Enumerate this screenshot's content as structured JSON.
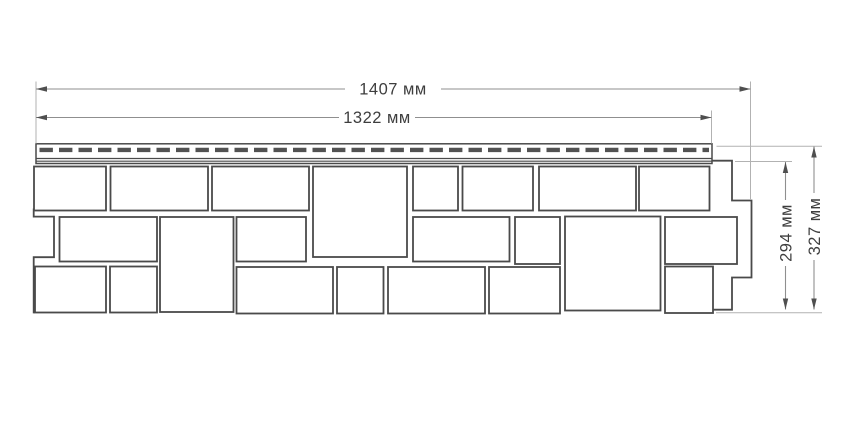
{
  "diagram": {
    "type": "technical-dimension-drawing",
    "subject": "facade-siding-panel-front-view",
    "background": "#ffffff",
    "colors": {
      "stone_outline": "#4a4a4a",
      "stone_fill": "#ffffff",
      "slot_fill": "#525252",
      "dim_line": "#8f8f8f",
      "ext_line": "#b2b2b2",
      "arrow": "#4f4f4f",
      "text": "#3e3e3e"
    },
    "labels": {
      "width_total": "1407 мм",
      "width_hem": "1322 мм",
      "height_panel": "294 мм",
      "height_total": "327 мм"
    },
    "geometry": {
      "canvas": {
        "w": 850,
        "h": 425
      },
      "hem": {
        "x1": 36,
        "y1": 143.8,
        "x2": 712,
        "y2": 163.5,
        "dash_y": 149.9,
        "dash_x1": 39.5,
        "dash_x2": 709,
        "dash_pattern": "13.4 6.1",
        "dash_width": 4.4,
        "inner_lines_y": [
          158.5,
          161.2
        ]
      },
      "stones": [
        [
          34,
          166.5,
          72,
          44
        ],
        [
          110.5,
          166.5,
          97.5,
          44
        ],
        [
          212,
          166.5,
          97,
          44
        ],
        [
          313,
          166.5,
          94,
          90.5
        ],
        [
          413,
          166.5,
          45,
          44
        ],
        [
          462.5,
          166.5,
          70.5,
          44
        ],
        [
          539,
          166.5,
          97,
          44
        ],
        [
          639,
          166.5,
          70.5,
          44
        ],
        [
          59.5,
          217,
          97.5,
          44.5
        ],
        [
          160,
          217,
          73.5,
          95
        ],
        [
          236.5,
          217,
          69.5,
          44.5
        ],
        [
          413,
          217,
          96.5,
          44.5
        ],
        [
          515,
          217,
          45,
          47
        ],
        [
          565,
          216.5,
          95.5,
          94
        ],
        [
          665,
          217,
          72,
          47
        ],
        [
          35,
          266.5,
          71,
          46
        ],
        [
          110,
          266.5,
          47,
          46
        ],
        [
          236.5,
          267,
          96.5,
          46.5
        ],
        [
          337,
          267,
          46.5,
          46.5
        ],
        [
          388,
          267,
          97,
          46.5
        ],
        [
          489,
          267,
          71,
          46.5
        ],
        [
          665,
          266.5,
          48,
          46.5
        ]
      ],
      "edges": {
        "left": "33.7,208.5 33.7,216.6 54,216.6 54,257.2 33.7,257.2 33.7,313.4",
        "right": "712,160.7 732,160.7 732,200.5 751.5,200.5 751.5,277.5 732,277.5 732,309.7 713.5,309.7"
      },
      "dims_horizontal": [
        {
          "name": "width-total",
          "label_key": "width_total",
          "y": 89,
          "x1": 36,
          "x2": 750.5,
          "gap": [
            345,
            441
          ],
          "label_x": 393,
          "ext": [
            [
              36,
              81.5,
              36,
              143.5
            ],
            [
              750.5,
              81.5,
              750.5,
              200
            ]
          ]
        },
        {
          "name": "width-hem",
          "label_key": "width_hem",
          "y": 117.5,
          "x1": 36,
          "x2": 711.5,
          "gap": [
            339,
            415
          ],
          "label_x": 377,
          "ext": [
            [
              711.5,
              110.5,
              711.5,
              143.5
            ]
          ]
        }
      ],
      "dims_vertical": [
        {
          "name": "height-panel",
          "label_key": "height_panel",
          "x": 785.5,
          "y1": 162,
          "y2": 309.5,
          "gap": [
            200,
            266
          ],
          "label_y": 233,
          "ext": [
            [
              735,
              161.5,
              792,
              161.5
            ]
          ]
        },
        {
          "name": "height-total",
          "label_key": "height_total",
          "x": 814,
          "y1": 146.5,
          "y2": 309.5,
          "gap": [
            193,
            260
          ],
          "label_y": 226.5,
          "ext": [
            [
              716.5,
              146.2,
              822,
              146.2
            ],
            [
              716,
              312.7,
              822,
              312.7
            ]
          ]
        }
      ]
    }
  }
}
